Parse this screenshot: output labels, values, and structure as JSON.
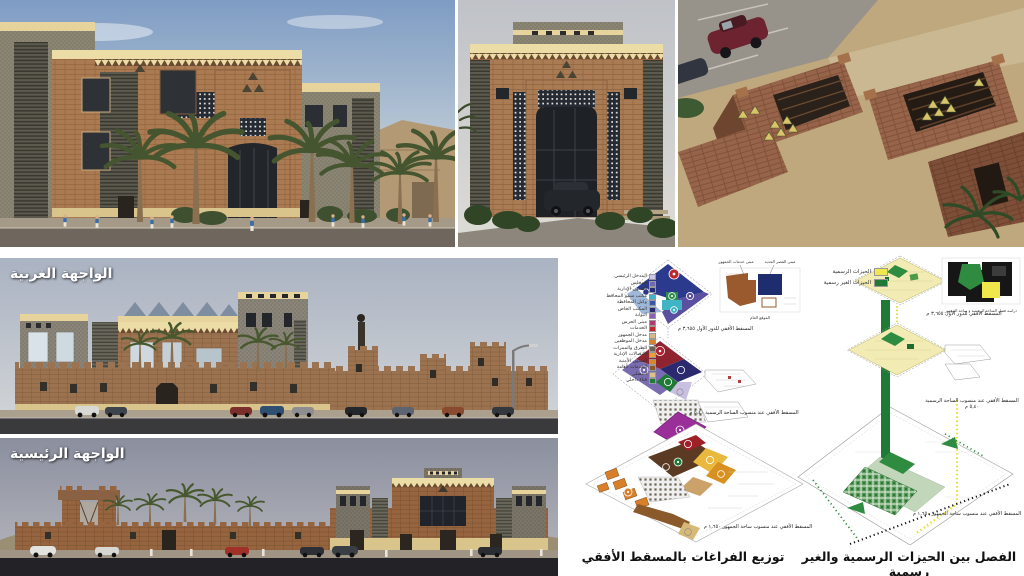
{
  "elevations": {
    "west_label": "الواجهة الغربية",
    "main_label": "الواجهة الرئيسية"
  },
  "diagram_left": {
    "title": "توزيع الفراغات بالمسقط الأفقي",
    "legend": [
      {
        "label": "المدخل الرئيسي",
        "color": "#cdc6e6"
      },
      {
        "label": "المجلس",
        "color": "#7468b0"
      },
      {
        "label": "الشئون الإدارية",
        "color": "#232e77"
      },
      {
        "label": "مكتب سمو المحافظ",
        "color": "#3fb4c9"
      },
      {
        "label": "وكيل المحافظة",
        "color": "#3a56a7"
      },
      {
        "label": "المكتب الخاص",
        "color": "#2b2a6e"
      },
      {
        "label": "البوابة",
        "color": "#8a5fb5"
      },
      {
        "label": "مبنى الحرس",
        "color": "#b03a6e"
      },
      {
        "label": "الخدمات",
        "color": "#c0272d"
      },
      {
        "label": "مدخل الجمهور",
        "color": "#d8b98a"
      },
      {
        "label": "مدخل الموظفين",
        "color": "#d9822b"
      },
      {
        "label": "الطرق والممرات",
        "color": "#6b6352"
      },
      {
        "label": "الاتصالات الإدارية",
        "color": "#e8a13a"
      },
      {
        "label": "الشئون الأمنية",
        "color": "#cf8a2e"
      },
      {
        "label": "الخدمات العامة",
        "color": "#8a5a2b"
      },
      {
        "label": "المصلى",
        "color": "#e3c08a"
      },
      {
        "label": "فناء داخلي",
        "color": "#1e7a34"
      }
    ],
    "captions": {
      "first_floor": "المسقط الأفقي للدور الأول ٣,٦٥٥ م",
      "formal_plaza_level": "المسقط الأفقي عند منسوب الساحة الرسمية ٥,٤٠ م",
      "public_plaza_level": "المسقط الأفقي عند منسوب ساحة الجمهور ١,٦٥٠ م"
    },
    "key_plan": {
      "label_services": "مبنى خدمات الجمهور",
      "label_palace": "مبنى القصر الجديد",
      "caption": "الموقع العام"
    }
  },
  "diagram_right": {
    "title": "الفصل بين الحيزات الرسمية والغير رسمية",
    "legend": [
      {
        "label": "الحيزات الرسمية",
        "color": "#f0e84a"
      },
      {
        "label": "الحيزات الغير رسمية",
        "color": "#1e7a34"
      }
    ],
    "captions": {
      "first_floor": "المسقط الأفقي للدور الأول ٣,٦٥٥ م",
      "formal_plaza_level": "المسقط الأفقي عند منسوب الساحة الرسمية ٥,٤٠ م",
      "public_plaza_level": "المسقط الأفقي عند منسوب ساحة الجمهور ١,٦٥٠ م"
    },
    "key_plan_caption": "دراسة فصل الساحة الرسمية و ساحة الجمهور"
  },
  "colors": {
    "formal_yellow": "#f0e84a",
    "informal_green": "#1e7a34",
    "brick": "#a97a52",
    "sky_blue": "#7e9cc4"
  }
}
